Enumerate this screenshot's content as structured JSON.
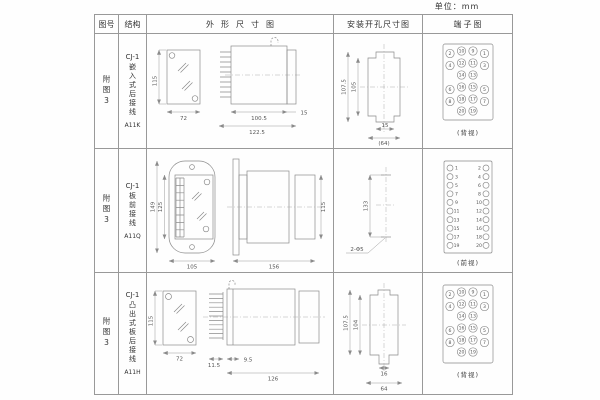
{
  "unit_label": "单位：mm",
  "header": {
    "figure": "图号",
    "structure": "结构",
    "outline": "外形尺寸图",
    "mounting": "安装开孔尺寸图",
    "terminal": "端子图"
  },
  "rows": [
    {
      "figure": "附图3",
      "model": "CJ-1",
      "structure": "嵌入式后接线",
      "code": "A11K",
      "outline": {
        "h": "115",
        "w": "72",
        "d1": "100.5",
        "d2": "122.5",
        "f": "15"
      },
      "mounting": {
        "v1": "107.5",
        "v2": "105",
        "h1": "15",
        "h2": "(64)"
      },
      "terminal": {
        "label": "(背视)",
        "r": 4.2,
        "items": [
          [
            "2",
            27,
            19.5
          ],
          [
            "10",
            38.5,
            17
          ],
          [
            "9",
            50,
            17
          ],
          [
            "1",
            61.5,
            19.5
          ],
          [
            "4",
            27,
            31.5
          ],
          [
            "12",
            38.5,
            29
          ],
          [
            "11",
            50,
            29
          ],
          [
            "3",
            61.5,
            31.5
          ],
          [
            "14",
            38.5,
            41
          ],
          [
            "13",
            50,
            41
          ],
          [
            "6",
            27,
            55.5
          ],
          [
            "16",
            38.5,
            53
          ],
          [
            "15",
            50,
            53
          ],
          [
            "5",
            61.5,
            55.5
          ],
          [
            "8",
            27,
            67.5
          ],
          [
            "18",
            38.5,
            65
          ],
          [
            "17",
            50,
            65
          ],
          [
            "7",
            61.5,
            67.5
          ],
          [
            "20",
            38.5,
            77
          ],
          [
            "19",
            50,
            77
          ]
        ]
      }
    },
    {
      "figure": "附图3",
      "model": "CJ-1",
      "structure": "板前接线",
      "code": "A11Q",
      "outline": {
        "h1": "149",
        "h2": "125",
        "w": "105",
        "d": "156",
        "rh": "115"
      },
      "mounting": {
        "v": "133",
        "holes": "2-Φ5"
      },
      "terminal": {
        "label": "(前视)",
        "r": 3,
        "items": [
          [
            "1",
            27,
            19,
            33.5
          ],
          [
            "2",
            63,
            19,
            56.5
          ],
          [
            "3",
            27,
            27.6,
            33.5
          ],
          [
            "4",
            63,
            27.6,
            56.5
          ],
          [
            "5",
            27,
            36.2,
            33.5
          ],
          [
            "6",
            63,
            36.2,
            56.5
          ],
          [
            "7",
            27,
            44.8,
            33.5
          ],
          [
            "8",
            63,
            44.8,
            56.5
          ],
          [
            "9",
            27,
            53.4,
            33.5
          ],
          [
            "10",
            63,
            53.4,
            56
          ],
          [
            "11",
            27,
            62,
            33.5
          ],
          [
            "12",
            63,
            62,
            56
          ],
          [
            "13",
            27,
            70.6,
            33.5
          ],
          [
            "14",
            63,
            70.6,
            56
          ],
          [
            "15",
            27,
            79.2,
            33.5
          ],
          [
            "16",
            63,
            79.2,
            56
          ],
          [
            "17",
            27,
            87.8,
            33.5
          ],
          [
            "18",
            63,
            87.8,
            56
          ],
          [
            "19",
            27,
            96.4,
            33.5
          ],
          [
            "20",
            63,
            96.4,
            56
          ]
        ]
      }
    },
    {
      "figure": "附图3",
      "model": "CJ-1",
      "structure": "凸出式板后接线",
      "code": "A11H",
      "outline": {
        "h": "115",
        "w": "72",
        "d1": "11.5",
        "d2": "9.5",
        "d3": "126"
      },
      "mounting": {
        "v1": "107.5",
        "v2": "104",
        "h1": "16",
        "h2": "64"
      },
      "terminal": {
        "label": "(背视)",
        "r": 4.2,
        "items": [
          [
            "2",
            27,
            21.5
          ],
          [
            "10",
            38.5,
            19
          ],
          [
            "9",
            50,
            19
          ],
          [
            "1",
            61.5,
            21.5
          ],
          [
            "4",
            27,
            33.5
          ],
          [
            "12",
            38.5,
            31
          ],
          [
            "11",
            50,
            31
          ],
          [
            "3",
            61.5,
            33.5
          ],
          [
            "14",
            38.5,
            43
          ],
          [
            "13",
            50,
            43
          ],
          [
            "6",
            27,
            57.5
          ],
          [
            "16",
            38.5,
            55
          ],
          [
            "15",
            50,
            55
          ],
          [
            "5",
            61.5,
            57.5
          ],
          [
            "8",
            27,
            69.5
          ],
          [
            "18",
            38.5,
            67
          ],
          [
            "17",
            50,
            67
          ],
          [
            "7",
            61.5,
            69.5
          ],
          [
            "20",
            38.5,
            79
          ],
          [
            "19",
            50,
            79
          ]
        ]
      }
    }
  ]
}
